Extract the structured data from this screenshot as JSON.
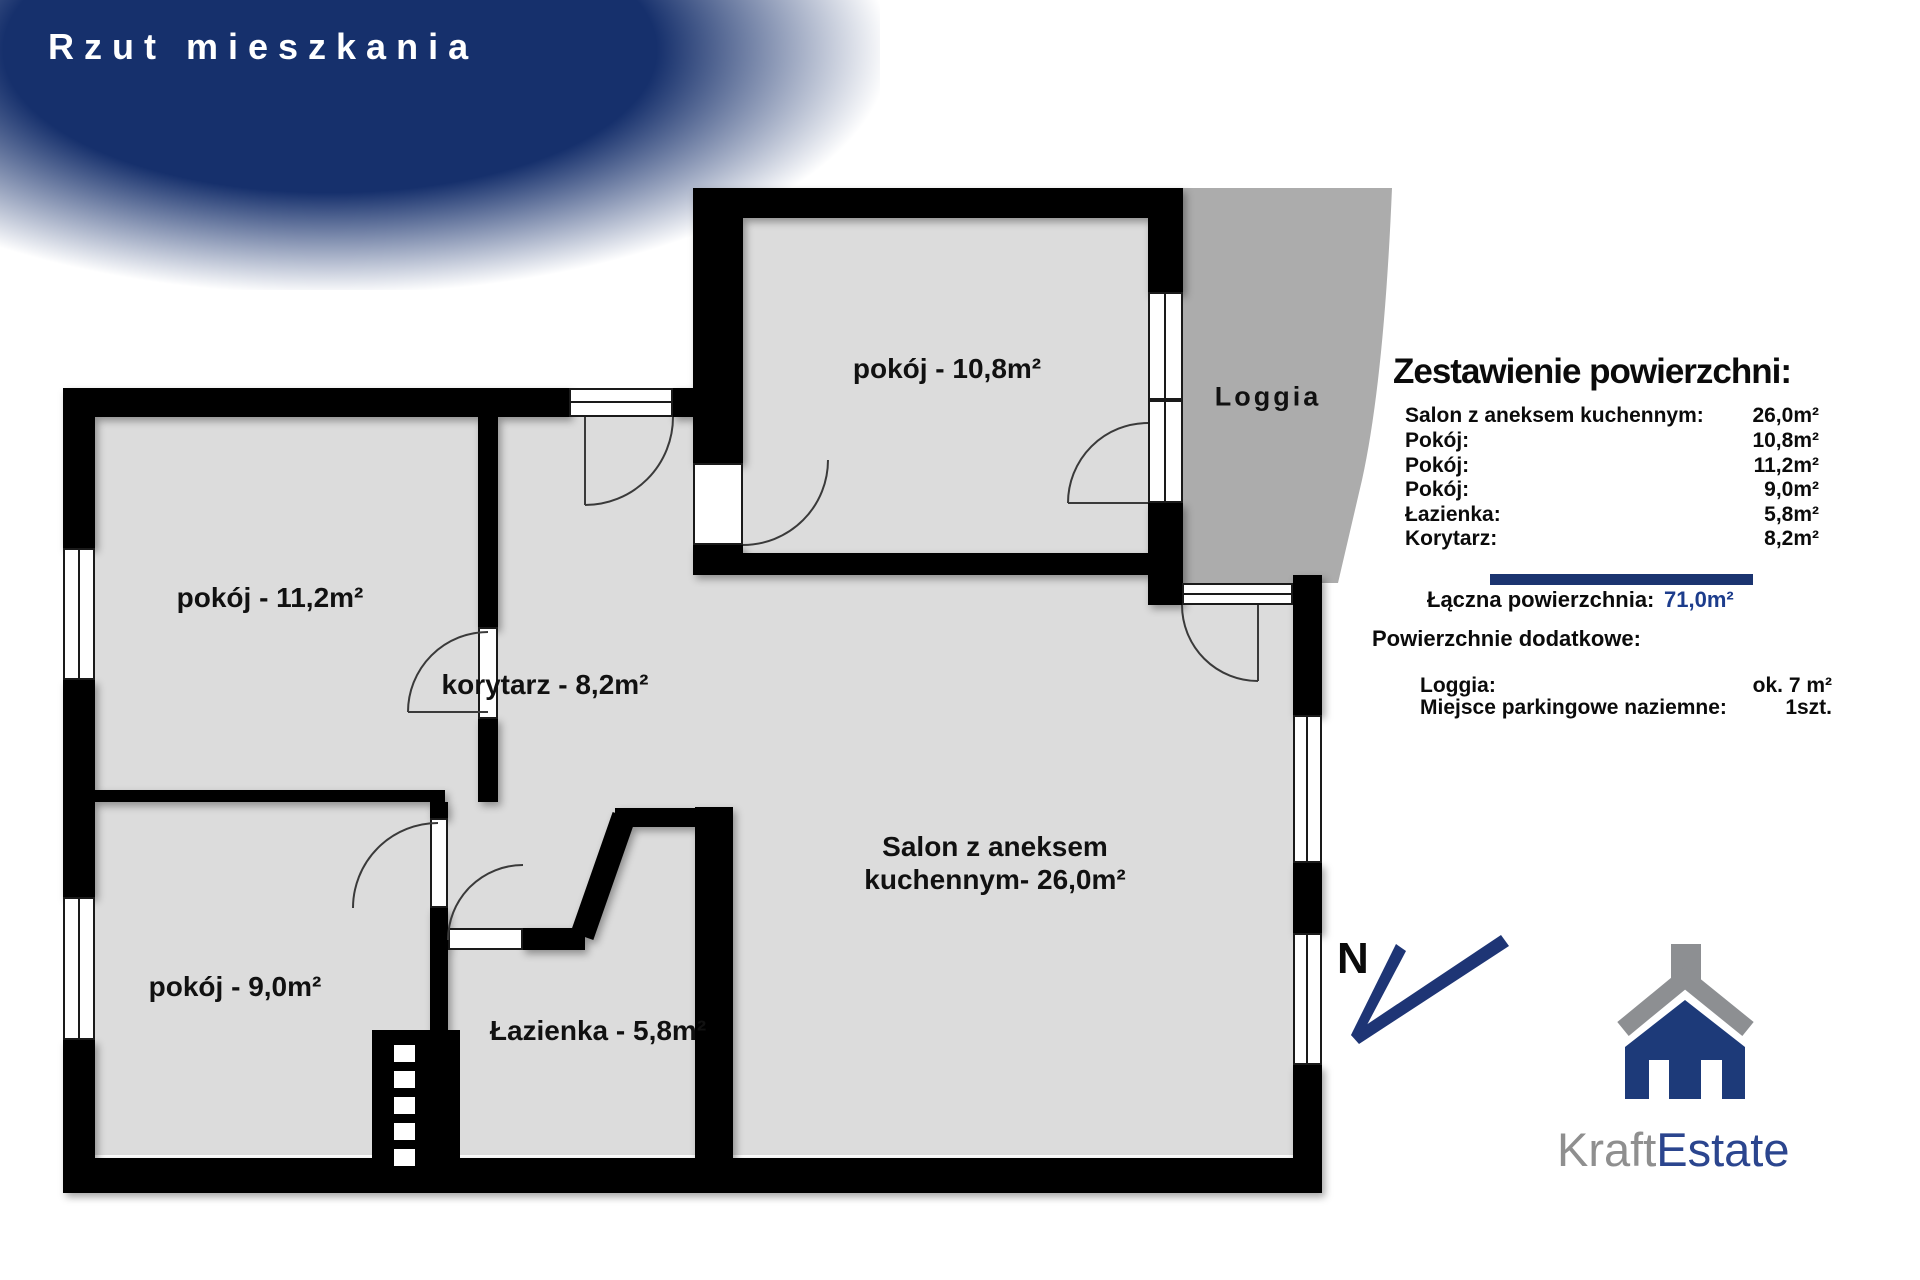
{
  "banner": {
    "title": "Rzut mieszkania"
  },
  "plan": {
    "room_labels": {
      "pokoj_top": "pokój - 10,8m²",
      "pokoj_left": "pokój - 11,2m²",
      "korytarz": "korytarz - 8,2m²",
      "pokoj_bottom": "pokój - 9,0m²",
      "lazienka": "Łazienka - 5,8m²",
      "salon_line1": "Salon z aneksem",
      "salon_line2": "kuchennym- 26,0m²",
      "loggia": "Loggia"
    }
  },
  "summary": {
    "title": "Zestawienie powierzchni:",
    "rows": [
      {
        "label": "Salon z aneksem kuchennym:",
        "value": "26,0m²"
      },
      {
        "label": "Pokój:",
        "value": "10,8m²"
      },
      {
        "label": "Pokój:",
        "value": "11,2m²"
      },
      {
        "label": "Pokój:",
        "value": "9,0m²"
      },
      {
        "label": "Łazienka:",
        "value": "5,8m²"
      },
      {
        "label": "Korytarz:",
        "value": "8,2m²"
      }
    ],
    "total_label": "Łączna powierzchnia:",
    "total_value": "71,0m²",
    "additional_title": "Powierzchnie dodatkowe:",
    "additional_rows": [
      {
        "label": "Loggia:",
        "value": "ok. 7 m²"
      },
      {
        "label": "Miejsce parkingowe naziemne:",
        "value": "1szt."
      }
    ]
  },
  "compass": {
    "north_label": "N"
  },
  "logo": {
    "name_part1": "Kraft",
    "name_part2": "Estate"
  },
  "colors": {
    "banner_navy": "#16306c",
    "wall_black": "#000000",
    "room_fill": "#dcdcdc",
    "loggia_fill": "#acacac",
    "accent_navy": "#1b3470",
    "total_value_navy": "#1c3c8c",
    "logo_gray": "#8d8f92",
    "logo_navy": "#1d3a79"
  }
}
